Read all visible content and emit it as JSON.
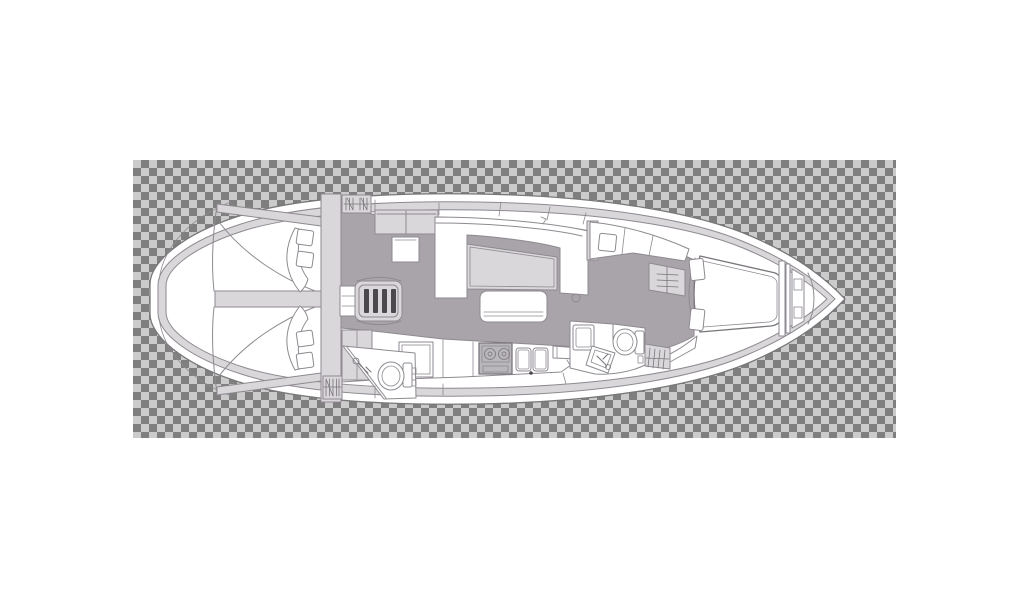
{
  "app": {
    "description": "transparent-background image preview of a sailing yacht interior floor plan, bow pointing right",
    "artboard": {
      "x": 133,
      "y": 160,
      "width": 763,
      "height": 278
    }
  },
  "transparency_checker": {
    "square_px": 8,
    "light": "#cbcbcb",
    "dark": "#7f7f7f"
  },
  "palette": {
    "hull": "#ffffff",
    "trim": "#d9d7da",
    "floor": "#a8a4aa",
    "panel": "#e6e5e7",
    "appliance": "#bab7bc",
    "dark": "#4b484e",
    "line_strong": "#7a767c",
    "line_soft": "#8e8a90"
  },
  "diagram": {
    "type": "floor-plan",
    "subject": "sailing-yacht-interior-deck-plan",
    "orientation": "bow-right",
    "features": [
      "hull",
      "side-deck",
      "aft-cabin-port",
      "aft-cabin-starboard",
      "aft-head",
      "companionway-steps",
      "nav-station",
      "chart-seat",
      "salon-u-settee",
      "salon-table",
      "salon-bench",
      "galley",
      "refrigerator",
      "stove",
      "double-sink",
      "mid-head",
      "shower",
      "toilet",
      "hanging-locker",
      "forward-cabin",
      "v-berth",
      "anchor-locker",
      "bow"
    ]
  }
}
